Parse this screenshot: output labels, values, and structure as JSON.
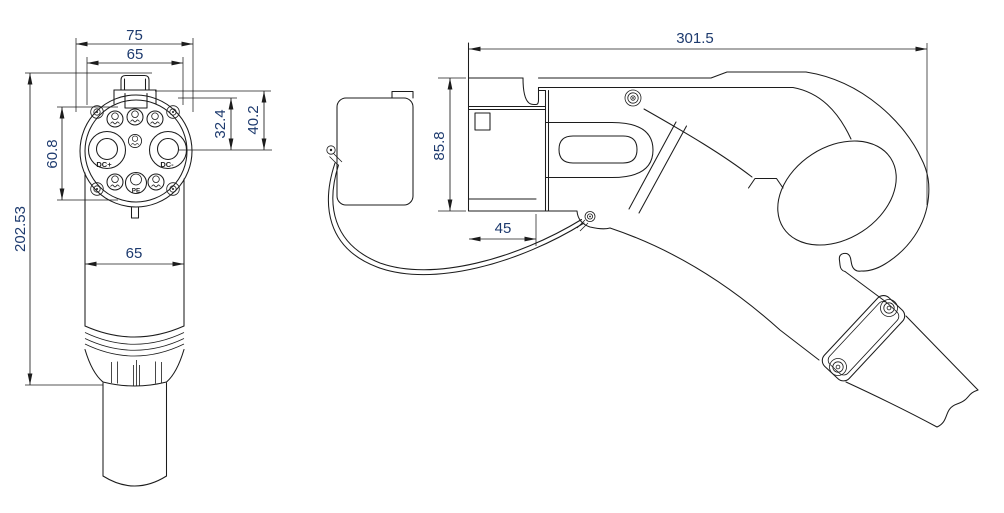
{
  "colors": {
    "line": "#1c1c1c",
    "dimtext": "#1d3a6e",
    "bg": "#ffffff"
  },
  "front_view": {
    "dims": {
      "flange_width": "75",
      "face_width": "65",
      "pin_field_height": "60.8",
      "overall_height": "202.53",
      "upper_pin_offset": "32.4",
      "outer_pin_offset": "40.2",
      "barrel_width": "65"
    },
    "pin_labels": {
      "dc_plus": "DC+",
      "dc_minus": "DC-",
      "pe": "PE"
    }
  },
  "side_view": {
    "dims": {
      "overall_length": "301.5",
      "body_height": "85.8",
      "nozzle_depth": "45"
    }
  }
}
